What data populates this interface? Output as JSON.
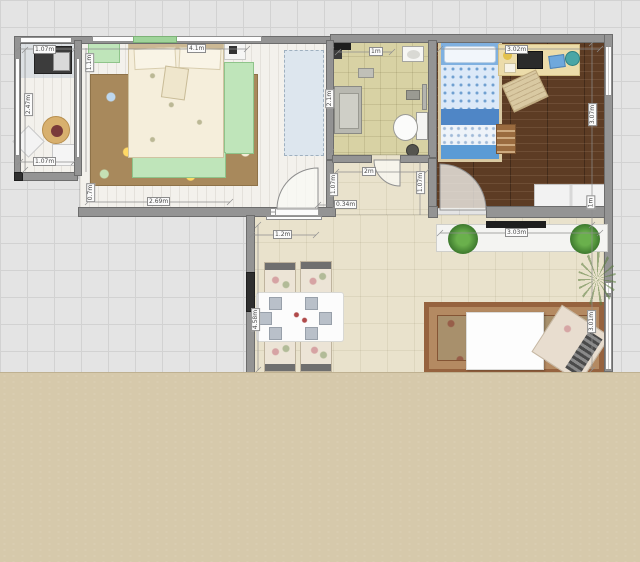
{
  "app": {
    "type": "floor-plan-canvas"
  },
  "labels": {
    "balcony_width_top": "1.07m",
    "balcony_height": "2.47m",
    "balcony_width_bottom": "1.07m",
    "bedroom_width_top": "4.1m",
    "bedroom_width_bottom": "2.69m",
    "divider_window_top": "1.1m",
    "divider_window_bottom": "0.7m",
    "bathroom_width": "1m",
    "bathroom_height": "2.1m",
    "kids_room_width": "3.02m",
    "kids_room_height": "3.07m",
    "right_window_height": "1m",
    "hall_width": "2m",
    "hall_height_left": "1.07m",
    "hall_height_right": "1.07m",
    "wall_gap": "0.34m",
    "corridor_width": "1.2m",
    "console_width": "3.03m",
    "living_height": "3.01m",
    "living_wall_length": "4.58m"
  },
  "colors": {
    "grid_bg": "#e4e4e4",
    "wall": "#949494",
    "wood_light": "#f3f1ec",
    "wood_dark": "#5d3c24",
    "tile_khaki": "#d8d2a4",
    "tile_beige": "#e9e2cc",
    "flat_beige": "#d6c9ab",
    "furniture_green": "#bfe5ba",
    "kids_bed_blue": "#7fb0e0",
    "bedroom_rug_brown": "#a8895c",
    "living_rug_brown": "#a8906c"
  }
}
